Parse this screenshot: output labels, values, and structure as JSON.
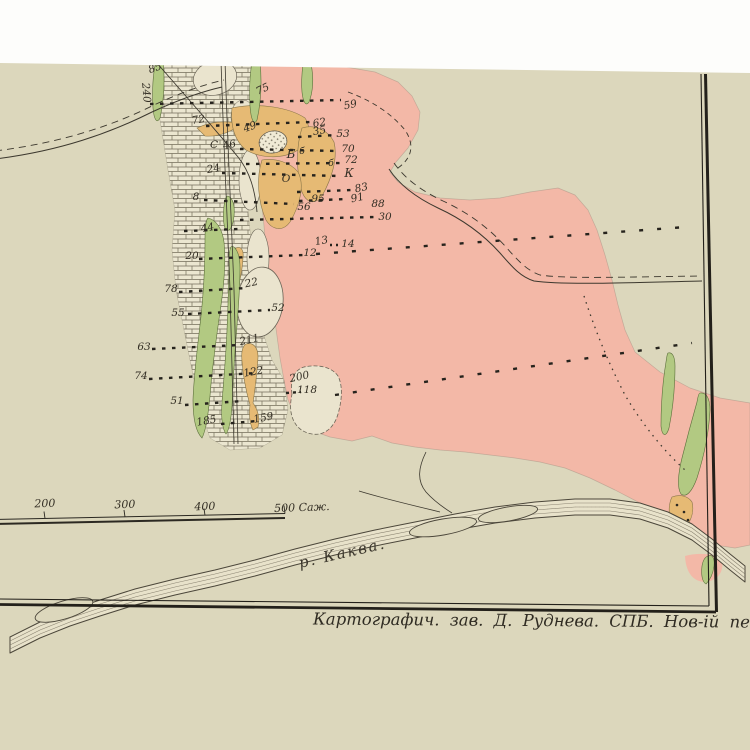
{
  "page": {
    "colors": {
      "white_margin": "#fdfdfb",
      "paper": "#dcd7bc",
      "ink": "#2c2922"
    }
  },
  "map": {
    "region_colors": {
      "pink": "#f3b8a7",
      "green": "#b2c982",
      "ochre": "#e6ba74",
      "limestone": "#ebe6d0",
      "lake": "#eae4ce",
      "river_fill": "#e8e2ca"
    },
    "caption": "Картографич. зав. Д. Руднева. СПБ. Нов-ій пер. 5.",
    "river_label": "р. Каква.",
    "scale_bar": {
      "unit": "Саж.",
      "labels": [
        {
          "text": "200",
          "x": 45,
          "y": 507
        },
        {
          "text": "300",
          "x": 125,
          "y": 508
        },
        {
          "text": "400",
          "x": 205,
          "y": 510
        },
        {
          "text": "500 Саж.",
          "x": 302,
          "y": 511
        }
      ]
    },
    "survey_points": [
      {
        "text": "85",
        "x": 156,
        "y": 71,
        "rot": -20
      },
      {
        "text": "240",
        "x": 143,
        "y": 93,
        "rot": 85
      },
      {
        "text": "75",
        "x": 264,
        "y": 92,
        "rot": -25
      },
      {
        "text": "59",
        "x": 351,
        "y": 108,
        "rot": -12
      },
      {
        "text": "72",
        "x": 199,
        "y": 123,
        "rot": -10
      },
      {
        "text": "49",
        "x": 251,
        "y": 130,
        "rot": -20
      },
      {
        "text": "62",
        "x": 320,
        "y": 126,
        "rot": -10
      },
      {
        "text": "35",
        "x": 320,
        "y": 134,
        "rot": -10
      },
      {
        "text": "53",
        "x": 343,
        "y": 137,
        "rot": 0
      },
      {
        "text": "С",
        "x": 214,
        "y": 148,
        "rot": 0
      },
      {
        "text": "46",
        "x": 230,
        "y": 148,
        "rot": -12
      },
      {
        "text": "70",
        "x": 348,
        "y": 152,
        "rot": 0
      },
      {
        "text": "Б",
        "x": 291,
        "y": 158,
        "rot": 0,
        "size": 12
      },
      {
        "text": "б",
        "x": 302,
        "y": 154,
        "rot": 0,
        "size": 9
      },
      {
        "text": "б",
        "x": 331,
        "y": 166,
        "rot": 0,
        "size": 9
      },
      {
        "text": "72",
        "x": 351,
        "y": 163,
        "rot": 0
      },
      {
        "text": "24",
        "x": 214,
        "y": 172,
        "rot": -10
      },
      {
        "text": "О",
        "x": 286,
        "y": 182,
        "rot": 0
      },
      {
        "text": "К",
        "x": 349,
        "y": 177,
        "rot": 0,
        "size": 12
      },
      {
        "text": "83",
        "x": 362,
        "y": 191,
        "rot": -12
      },
      {
        "text": "91",
        "x": 358,
        "y": 201,
        "rot": -12
      },
      {
        "text": "95",
        "x": 318,
        "y": 202,
        "rot": 0
      },
      {
        "text": "56",
        "x": 304,
        "y": 210,
        "rot": 0
      },
      {
        "text": "88",
        "x": 378,
        "y": 207,
        "rot": 0
      },
      {
        "text": "8",
        "x": 196,
        "y": 200,
        "rot": 0
      },
      {
        "text": "30",
        "x": 385,
        "y": 220,
        "rot": 0
      },
      {
        "text": "44",
        "x": 208,
        "y": 231,
        "rot": -10
      },
      {
        "text": "13",
        "x": 322,
        "y": 244,
        "rot": -10
      },
      {
        "text": "14",
        "x": 348,
        "y": 247,
        "rot": 0
      },
      {
        "text": "20",
        "x": 192,
        "y": 259,
        "rot": 0
      },
      {
        "text": "12",
        "x": 310,
        "y": 256,
        "rot": 0
      },
      {
        "text": "78",
        "x": 171,
        "y": 292,
        "rot": 0
      },
      {
        "text": "22",
        "x": 252,
        "y": 286,
        "rot": -12
      },
      {
        "text": "55",
        "x": 178,
        "y": 316,
        "rot": 0
      },
      {
        "text": "52",
        "x": 278,
        "y": 311,
        "rot": 0
      },
      {
        "text": "63",
        "x": 144,
        "y": 350,
        "rot": 0
      },
      {
        "text": "211",
        "x": 250,
        "y": 343,
        "rot": -12
      },
      {
        "text": "74",
        "x": 141,
        "y": 379,
        "rot": 0
      },
      {
        "text": "122",
        "x": 254,
        "y": 375,
        "rot": -10
      },
      {
        "text": "200",
        "x": 300,
        "y": 380,
        "rot": -12
      },
      {
        "text": "118",
        "x": 307,
        "y": 393,
        "rot": 0
      },
      {
        "text": "51",
        "x": 177,
        "y": 404,
        "rot": 0
      },
      {
        "text": "185",
        "x": 207,
        "y": 424,
        "rot": -10
      },
      {
        "text": "159",
        "x": 264,
        "y": 421,
        "rot": -10
      }
    ]
  }
}
